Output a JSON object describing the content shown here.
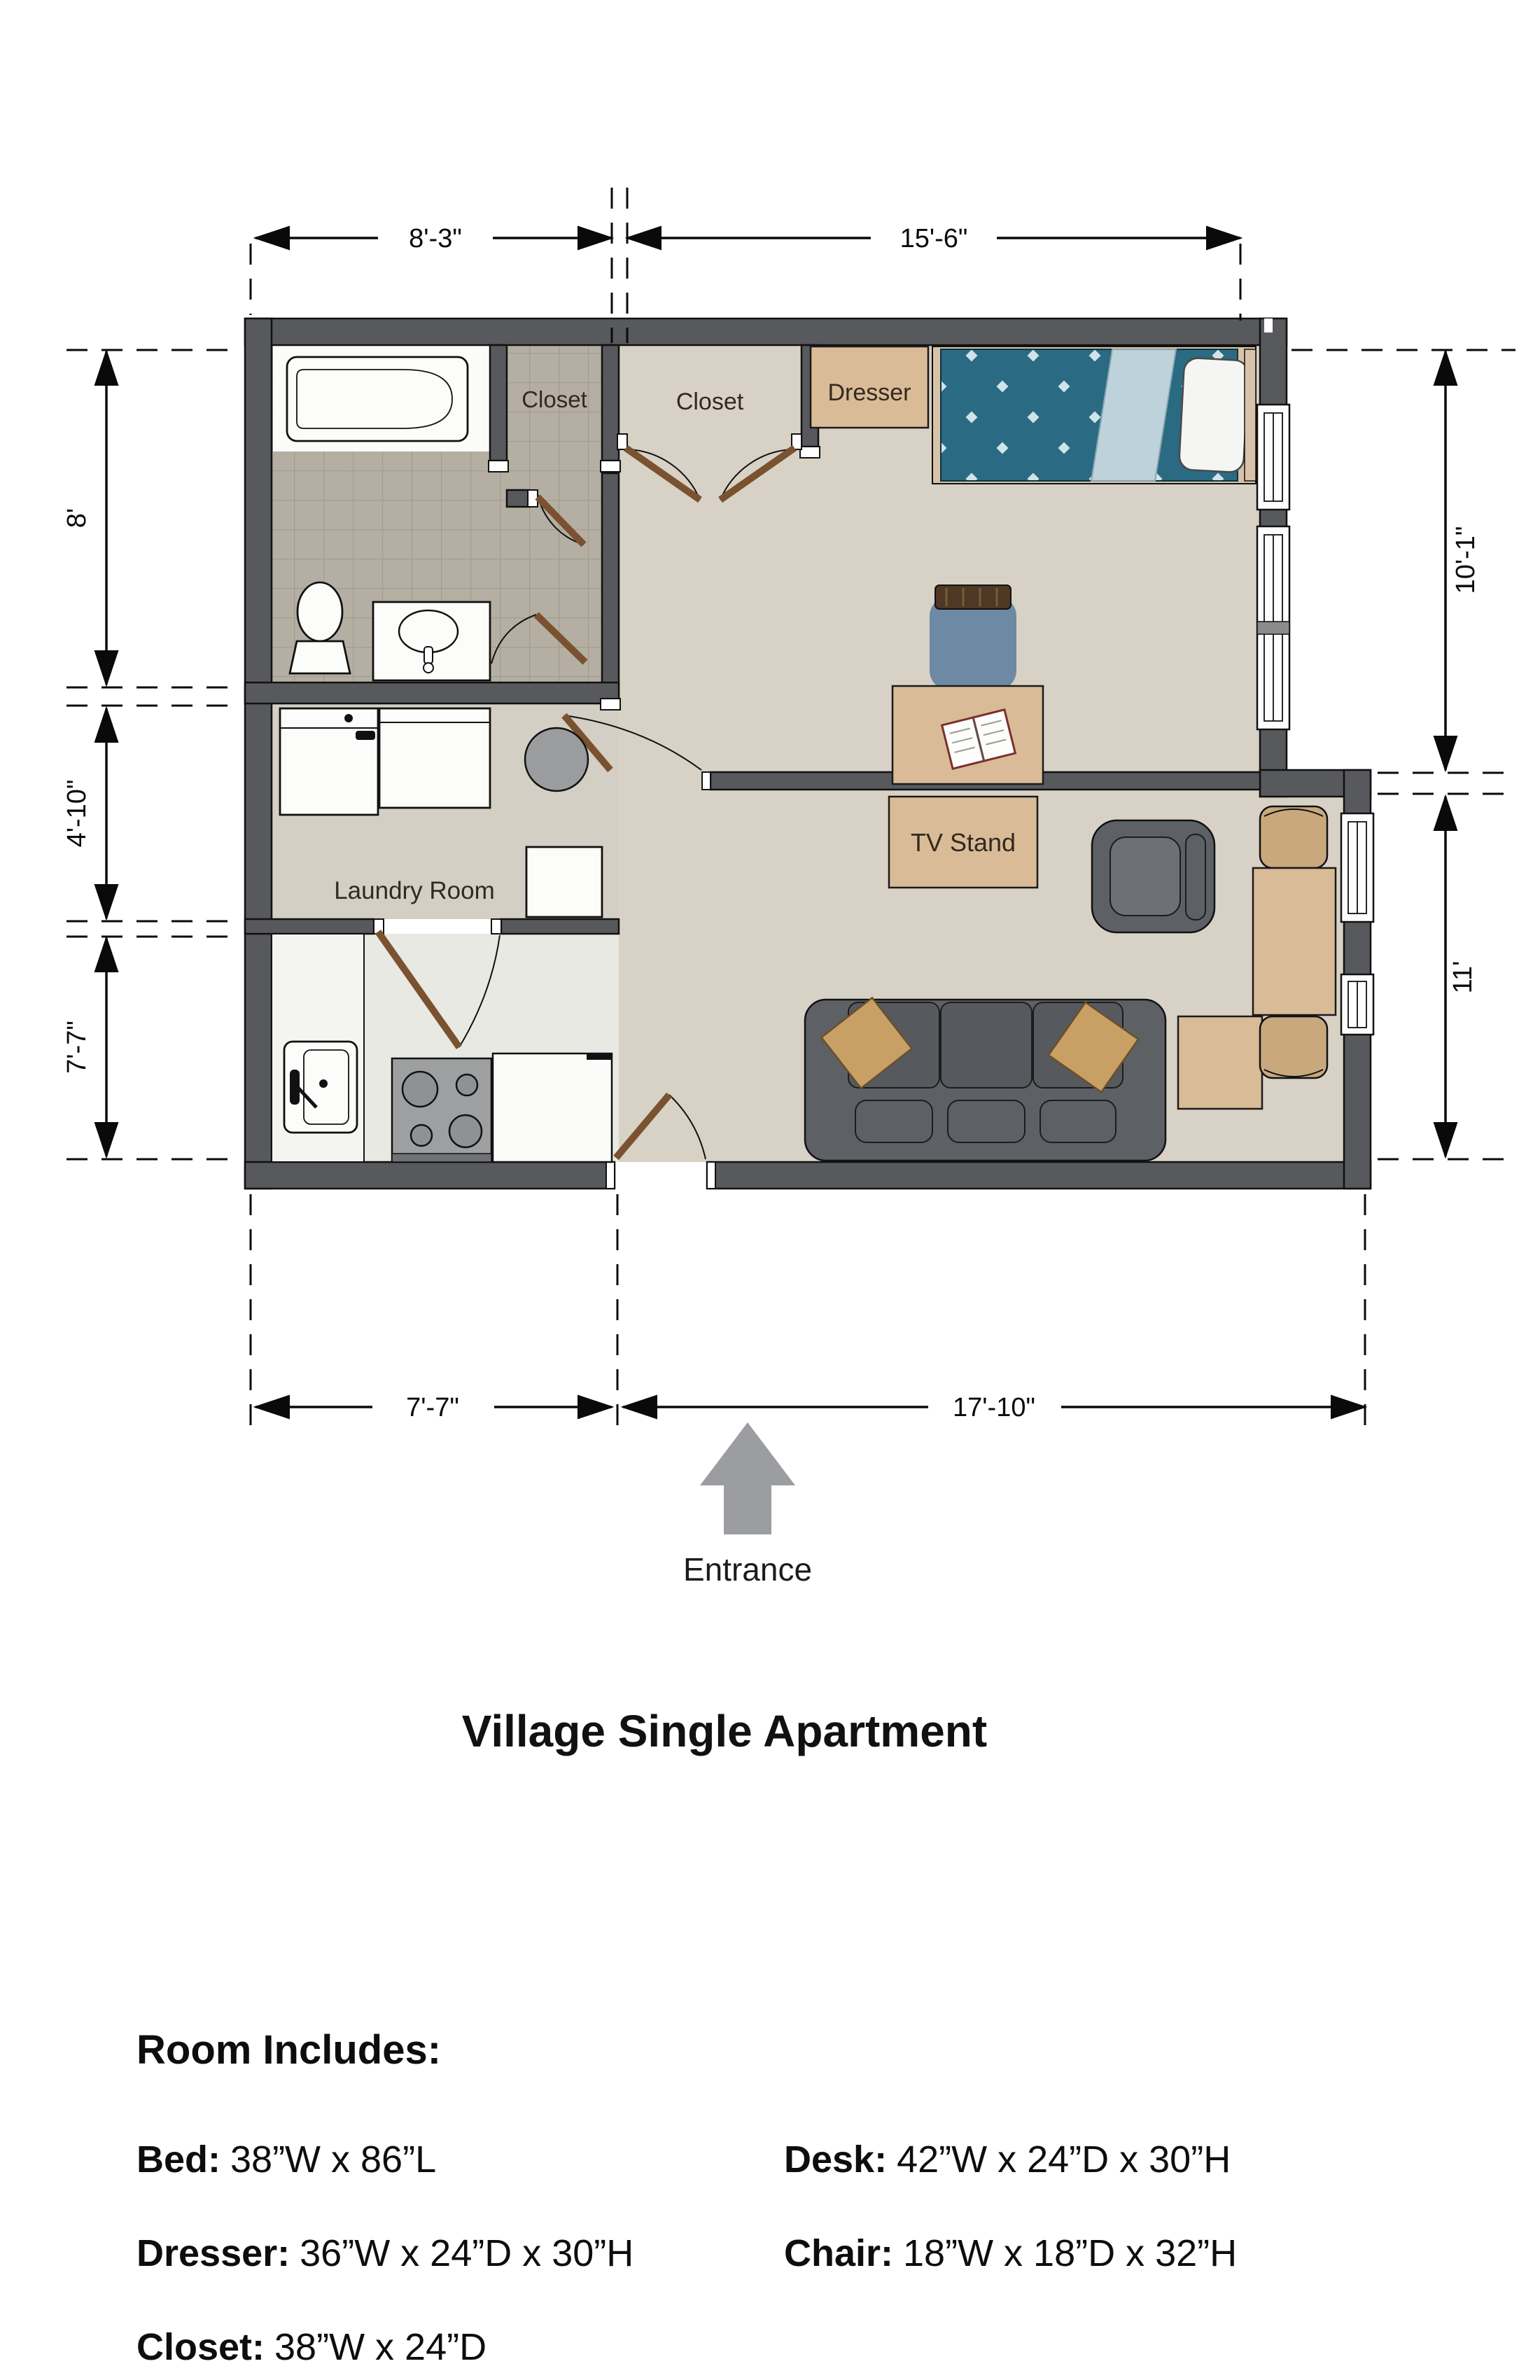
{
  "title": "Village Single Apartment",
  "entrance": "Entrance",
  "rooms": {
    "closet1": "Closet",
    "closet2": "Closet",
    "laundry": "Laundry Room"
  },
  "furniture": {
    "dresser": "Dresser",
    "tv_stand": "TV Stand"
  },
  "dims": {
    "top_left": "8'-3\"",
    "top_right": "15'-6\"",
    "left_bath": "8'",
    "left_laundry": "4'-10\"",
    "left_kitchen": "7'-7\"",
    "right_bedroom": "10'-1\"",
    "right_living": "11'",
    "bottom_kitchen": "7'-7\"",
    "bottom_living": "17'-10\""
  },
  "includes": {
    "heading": "Room Includes:",
    "items": [
      {
        "label": "Bed:",
        "value": "38”W x 86”L"
      },
      {
        "label": "Dresser:",
        "value": "36”W x 24”D x 30”H"
      },
      {
        "label": "Closet:",
        "value": "38”W x 24”D"
      },
      {
        "label": "Desk:",
        "value": "42”W x 24”D x 30”H"
      },
      {
        "label": "Chair:",
        "value": "18”W x 18”D x 32”H"
      }
    ]
  },
  "colors": {
    "wall": "#58595c",
    "floor_main": "#d7d2c5",
    "floor_laundry": "#d3cfc4",
    "floor_kitchen": "#e9e9e4",
    "floor_tile": "#b5afa3",
    "wood": "#d9bb97",
    "bed_teal": "#2a6a82",
    "bed_fold": "#bdd2da",
    "sofa_gray": "#5d6165",
    "pillow_tan": "#c8a065",
    "chair_blue": "#6d89a4",
    "arrow_gray": "#9b9da0"
  }
}
